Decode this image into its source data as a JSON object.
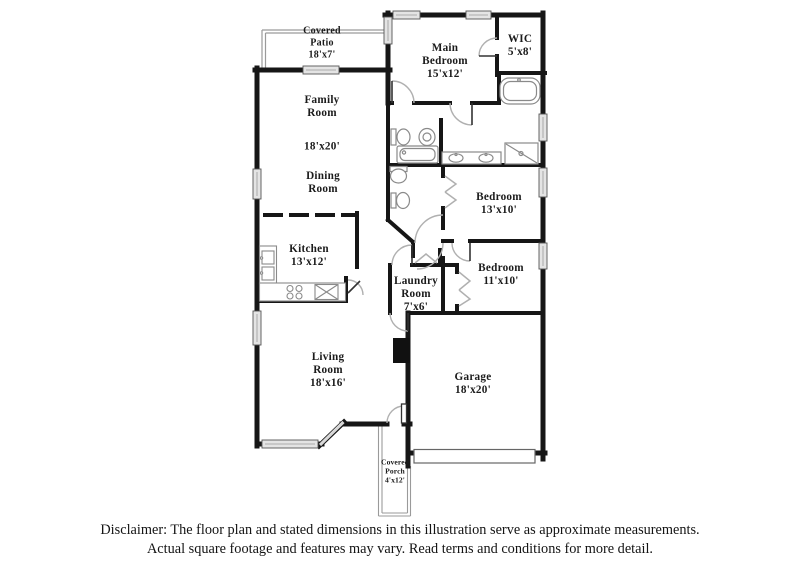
{
  "floor_plan": {
    "rooms": [
      {
        "id": "covered-patio",
        "label": "Covered\nPatio\n18'x7'"
      },
      {
        "id": "main-bedroom",
        "label": "Main\nBedroom\n15'x12'"
      },
      {
        "id": "wic",
        "label": "WIC\n5'x8'"
      },
      {
        "id": "family-room",
        "label": "Family\nRoom"
      },
      {
        "id": "family-room-dim",
        "label": "18'x20'"
      },
      {
        "id": "dining-room",
        "label": "Dining\nRoom"
      },
      {
        "id": "kitchen",
        "label": "Kitchen\n13'x12'"
      },
      {
        "id": "bedroom-13x10",
        "label": "Bedroom\n13'x10'"
      },
      {
        "id": "bedroom-11x10",
        "label": "Bedroom\n11'x10'"
      },
      {
        "id": "laundry-room",
        "label": "Laundry\nRoom\n7'x6'"
      },
      {
        "id": "living-room",
        "label": "Living\nRoom\n18'x16'"
      },
      {
        "id": "garage",
        "label": "Garage\n18'x20'"
      },
      {
        "id": "covered-porch",
        "label": "Covered\nPorch\n4'x12'"
      }
    ],
    "colors": {
      "wall": "#161616",
      "window_fill": "#e4e4e4",
      "fixture_outline": "#8a8a8a",
      "door_arc": "#b0b0b0"
    }
  },
  "disclaimer": {
    "line1": "Disclaimer: The floor plan and stated dimensions in this illustration serve as approximate measurements.",
    "line2": "Actual square footage and features may vary. Read terms and conditions for more detail."
  }
}
